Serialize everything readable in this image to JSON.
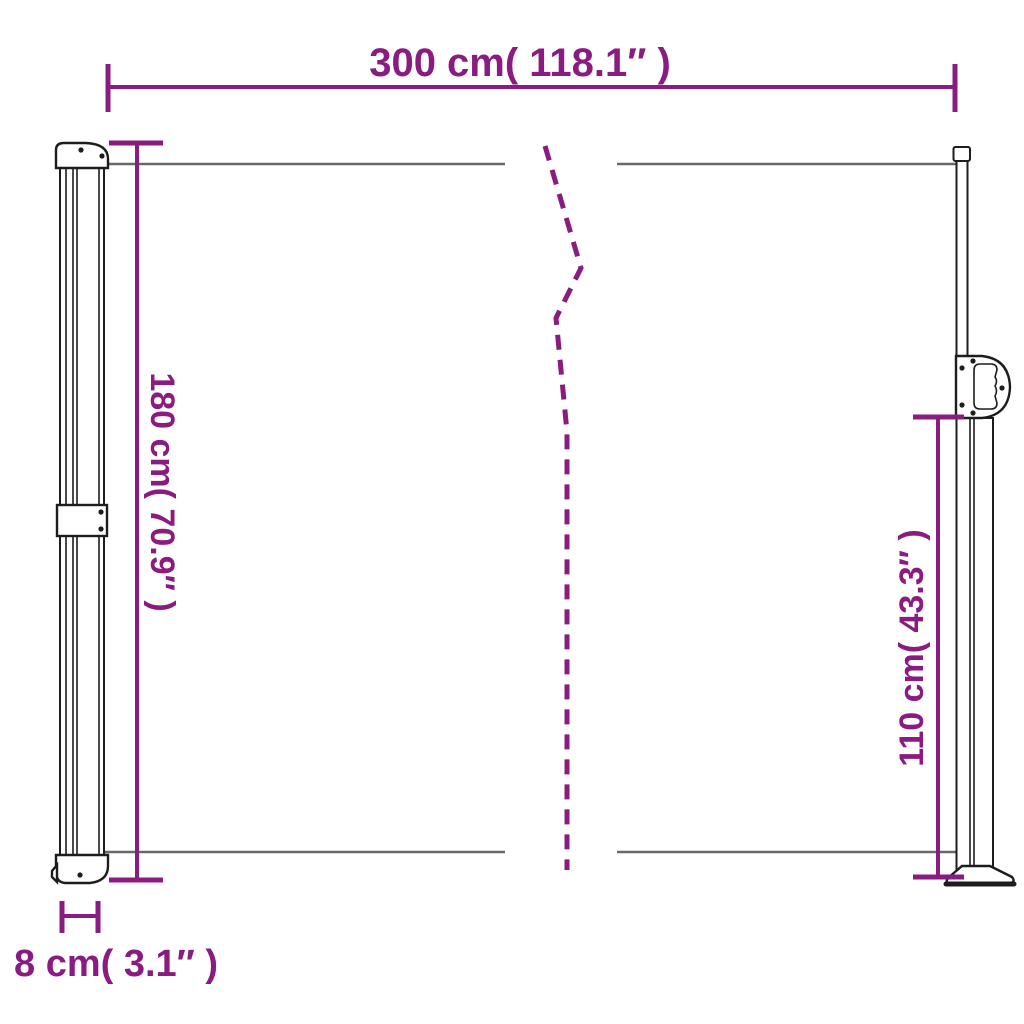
{
  "diagram_title": "retractable-side-awning-dimension-diagram",
  "dimensions": {
    "width": {
      "label": "300 cm( 118.1″ )"
    },
    "height_left": {
      "label": "180 cm( 70.9″ )"
    },
    "height_right": {
      "label": "110 cm( 43.3″ )"
    },
    "depth": {
      "label": "8 cm( 3.1″ )"
    }
  },
  "colors": {
    "dimension": "#8A1B80",
    "fabric_line": "#686868",
    "outline": "#1d1d1d",
    "background": "#ffffff"
  }
}
